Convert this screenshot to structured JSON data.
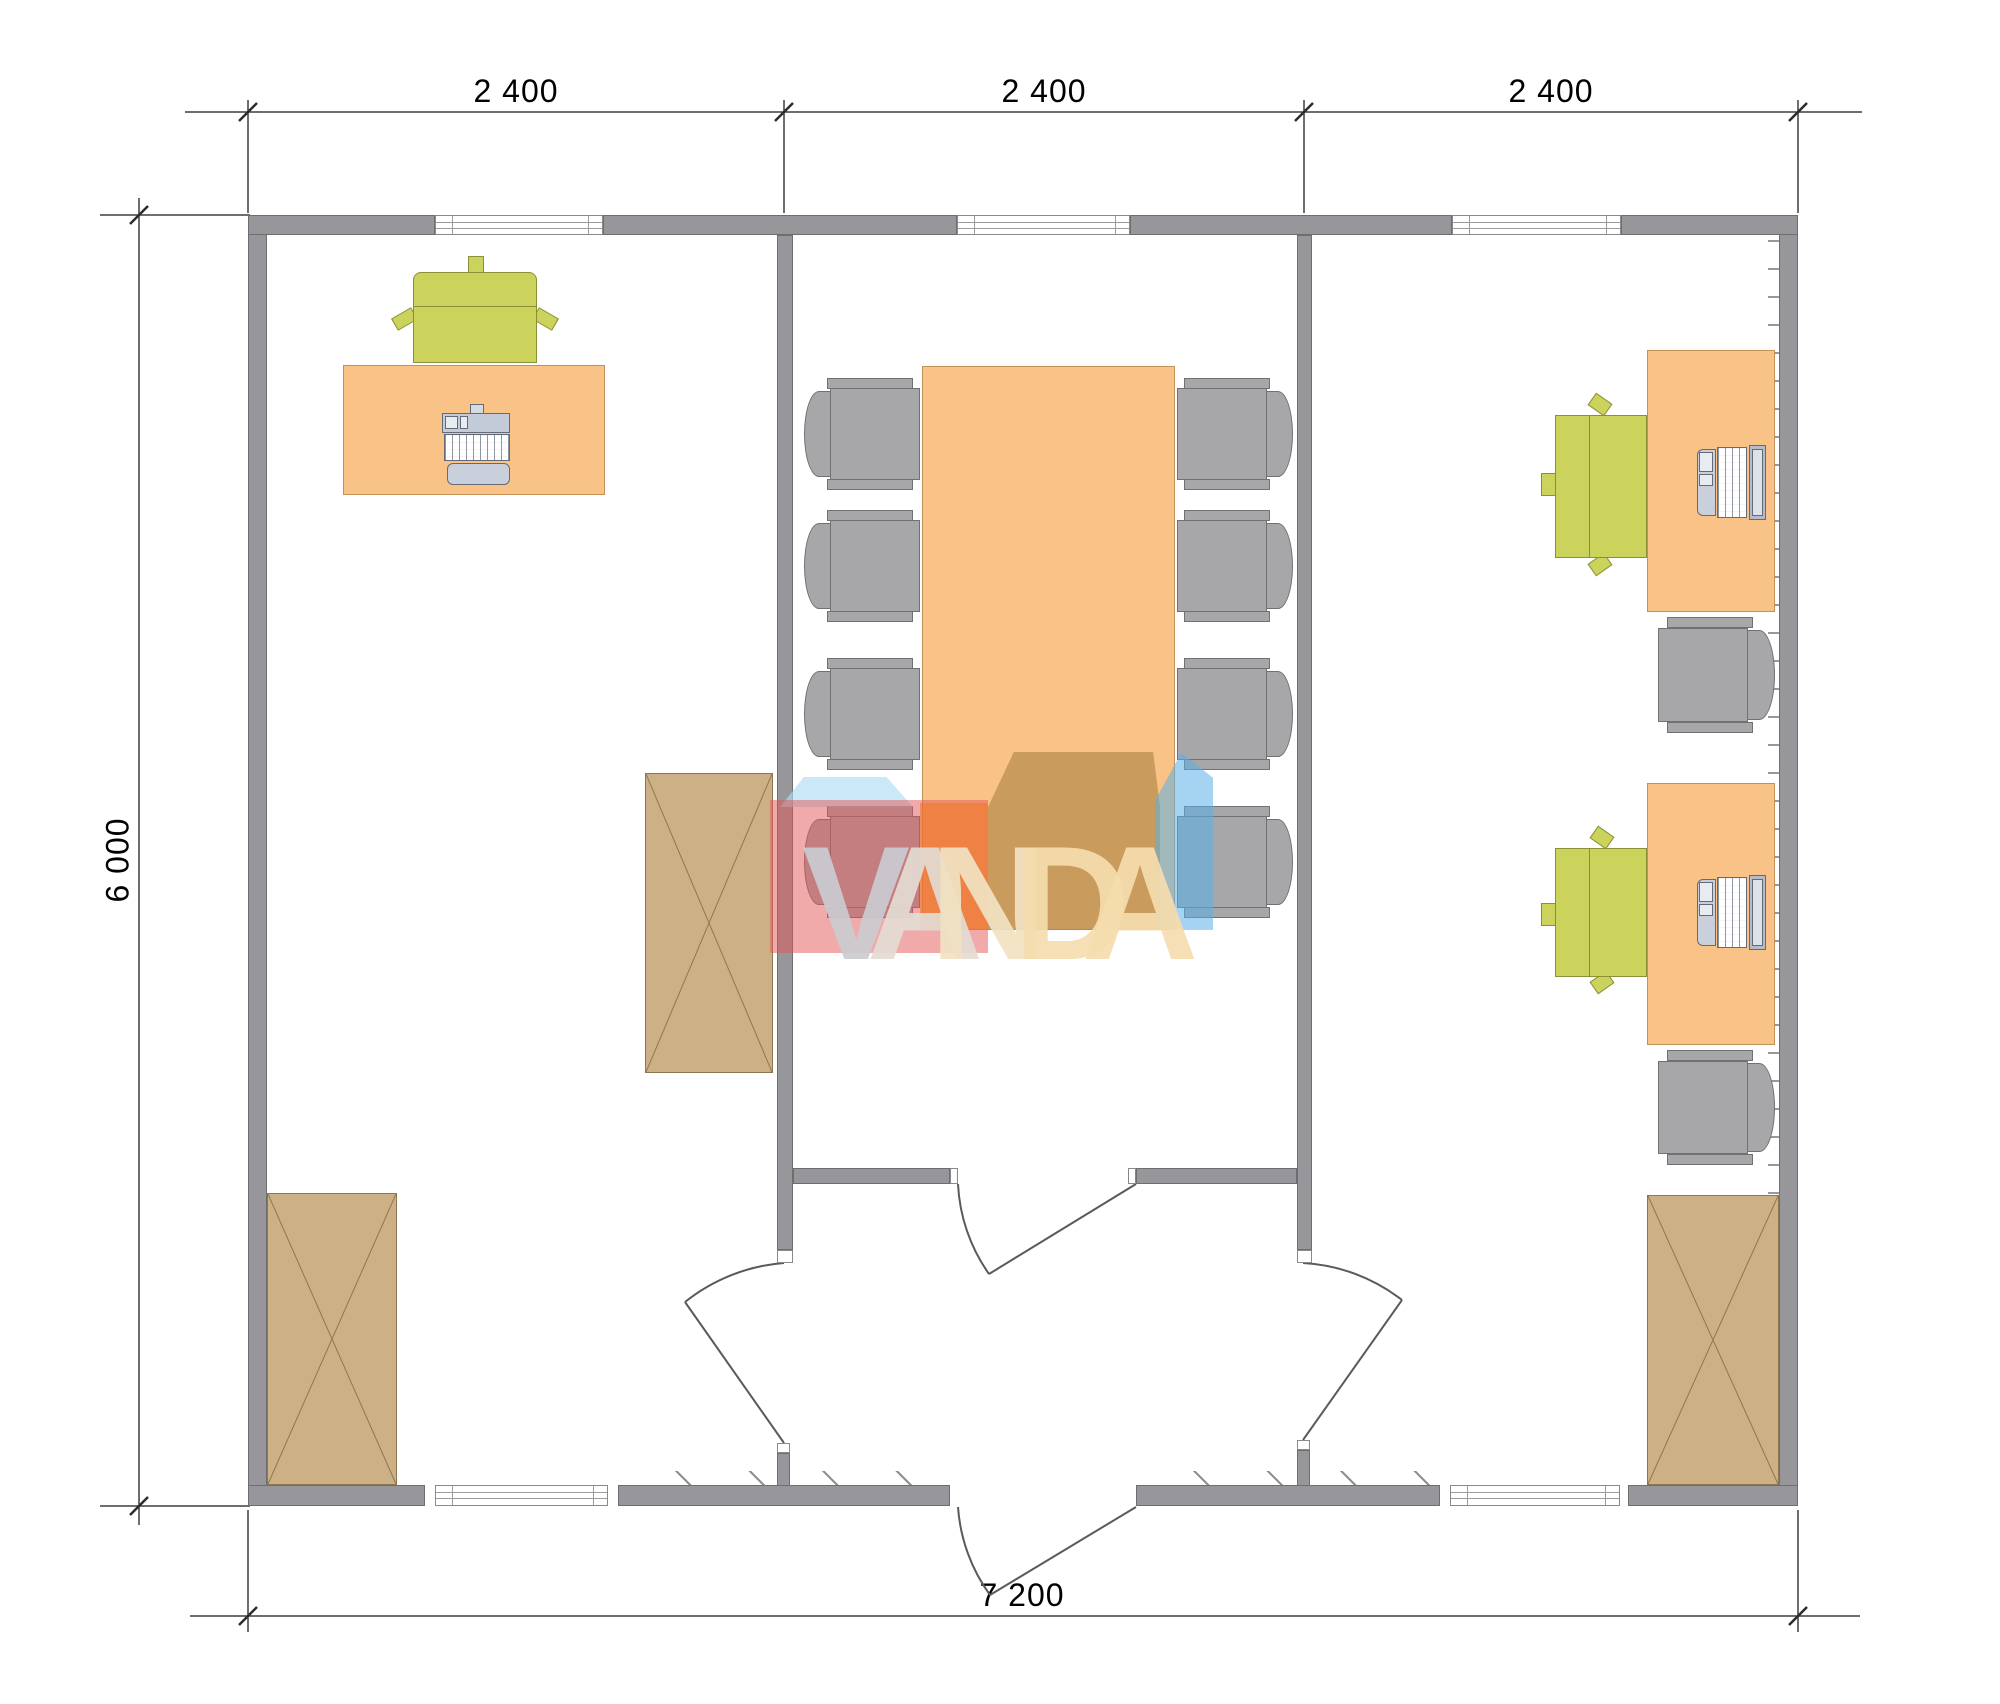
{
  "plan": {
    "type": "office-floor-plan",
    "rooms": [
      "left-office",
      "meeting-room",
      "right-office"
    ],
    "furniture": {
      "left_office": [
        "desk-with-computer",
        "office-chair",
        "cabinet",
        "cabinet"
      ],
      "meeting_room": [
        "conference-table",
        "8-chairs",
        "double-door"
      ],
      "right_office": [
        "desk-with-laptop",
        "desk-with-laptop",
        "2-office-chairs",
        "2-side-chairs",
        "cabinet"
      ]
    }
  },
  "dimensions": {
    "top": [
      "2 400",
      "2 400",
      "2 400"
    ],
    "left": "6 000",
    "bottom": "7 200"
  },
  "watermark": {
    "text": "VANDA",
    "letters": [
      "V",
      "A",
      "N",
      "D",
      "A"
    ]
  },
  "colors": {
    "wall": "#97979b",
    "desk": "#f9c388",
    "chair_green": "#cbd35c",
    "chair_gray": "#a7a7aa",
    "cabinet": "#cdb085",
    "dimension_text": "#000000",
    "watermark_red": "#e25555",
    "watermark_orange": "#ee7a26",
    "watermark_brown": "#a8803f",
    "watermark_lightblue": "#aedcf2",
    "watermark_blue": "#59b0e6"
  }
}
